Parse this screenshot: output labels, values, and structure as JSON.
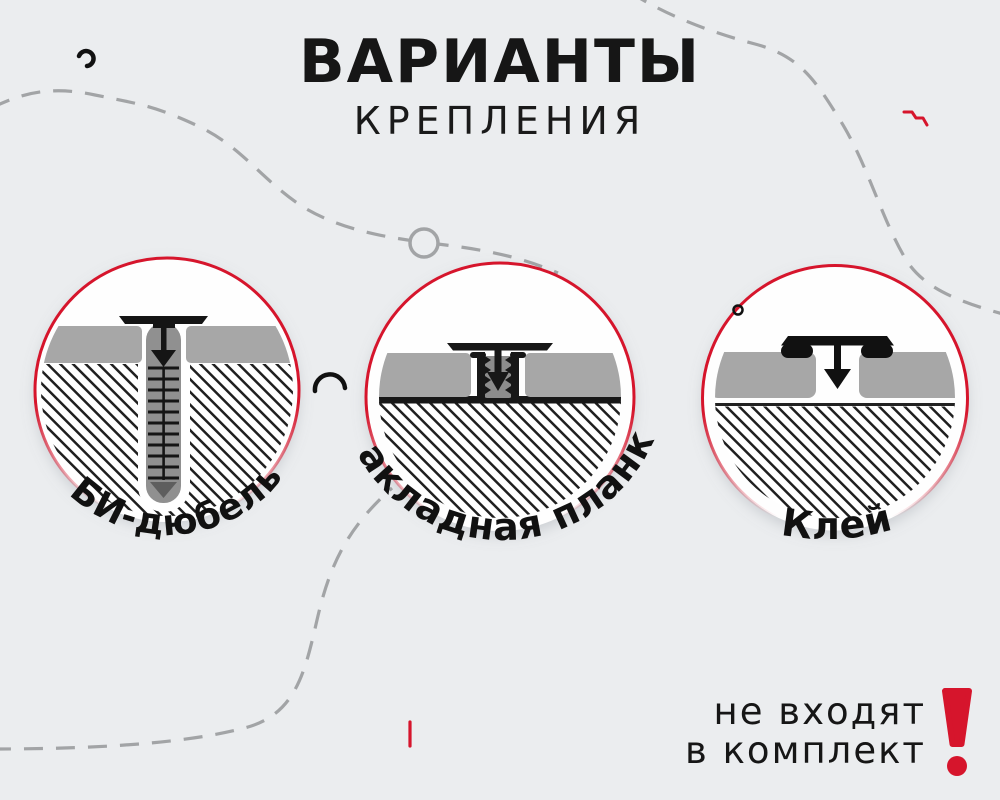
{
  "title": {
    "line1": "ВАРИАНТЫ",
    "line2": "КРЕПЛЕНИЯ"
  },
  "options": [
    {
      "id": "bi-dowel",
      "label": "БИ-дюбель",
      "icon": "bi-dowel-diagram"
    },
    {
      "id": "mounting-plate",
      "label": "Закладная планка",
      "icon": "mounting-plate-diagram"
    },
    {
      "id": "glue",
      "label": "Клей",
      "icon": "glue-diagram"
    }
  ],
  "note": {
    "line1": "не входят",
    "line2": "в комплект",
    "icon": "exclamation-icon"
  },
  "decorations": [
    "dashed-curve-top-left",
    "dashed-curve-top-right",
    "dashed-curve-bottom-left",
    "ring-icon",
    "comma-squiggle-icon",
    "zigzag-squiggle-icon",
    "arc-squiggle-icon",
    "red-tick-icon",
    "dot-ring-icon"
  ],
  "colors": {
    "background": "#EBEDEF",
    "accent_red": "#D6152C",
    "dash_gray": "#A2A4A6",
    "panel_gray": "#A7A7A7",
    "subfloor_ink": "#171717",
    "dowel_gray": "#909090",
    "ink": "#161616",
    "circle_fill": "#FEFEFE"
  }
}
